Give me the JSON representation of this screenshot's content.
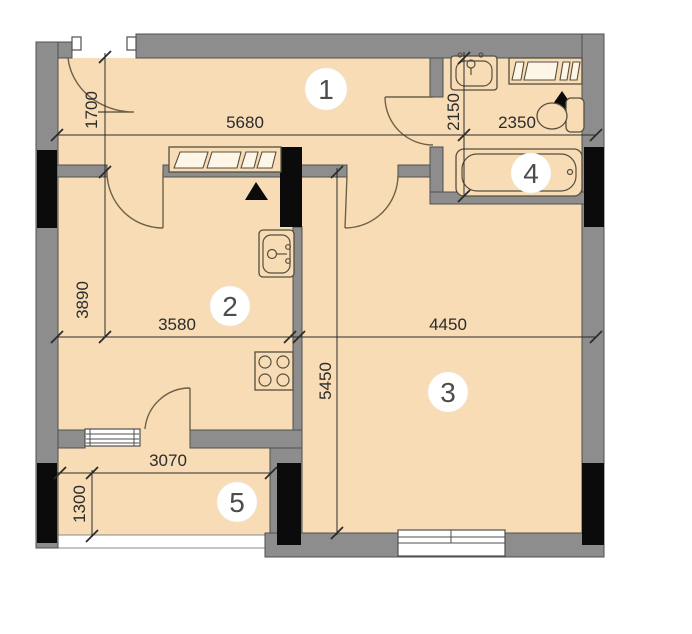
{
  "plan": {
    "rooms": [
      {
        "number": "1"
      },
      {
        "number": "2"
      },
      {
        "number": "3"
      },
      {
        "number": "4"
      },
      {
        "number": "5"
      }
    ],
    "dims": [
      {
        "id": "hall-width",
        "value": "5680"
      },
      {
        "id": "hall-depth",
        "value": "1700"
      },
      {
        "id": "bath-depth",
        "value": "2150"
      },
      {
        "id": "bath-width",
        "value": "2350"
      },
      {
        "id": "kitchen-depth",
        "value": "3890"
      },
      {
        "id": "kitchen-width",
        "value": "3580"
      },
      {
        "id": "living-width",
        "value": "4450"
      },
      {
        "id": "living-depth",
        "value": "5450"
      },
      {
        "id": "balcony-width",
        "value": "3070"
      },
      {
        "id": "balcony-depth",
        "value": "1300"
      }
    ],
    "fixtures": [
      "entrance-door-icon",
      "door-swing-icon",
      "wardrobe-icon",
      "washbasin-icon",
      "toilet-icon",
      "bathtub-icon",
      "vent-marker-icon",
      "kitchen-sink-icon",
      "stove-icon",
      "window-icon",
      "balcony-window-icon",
      "structural-column-icon"
    ],
    "colors": {
      "floor": "#f7dcb5",
      "wall": "#8d8d8d",
      "wall_outline": "#4f4f4f",
      "column": "#0b0b0b",
      "dimension": "#2b2b2b",
      "door_arc": "#6e6147",
      "fixture_outline": "#564f3e"
    }
  }
}
